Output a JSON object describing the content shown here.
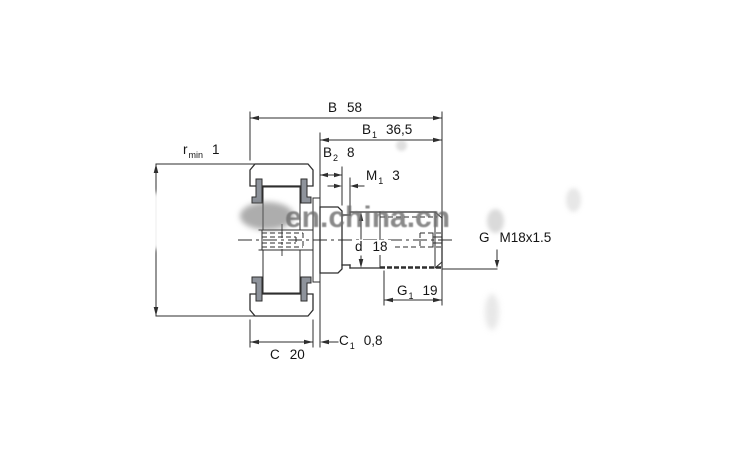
{
  "watermark": {
    "text": "en.china.cn"
  },
  "dimensions": {
    "r_min": {
      "symbol": "r",
      "subscript": "min",
      "value": "1"
    },
    "B": {
      "symbol": "B",
      "subscript": "",
      "value": "58"
    },
    "B1": {
      "symbol": "B",
      "subscript": "1",
      "value": "36,5"
    },
    "B2": {
      "symbol": "B",
      "subscript": "2",
      "value": "8"
    },
    "M1": {
      "symbol": "M",
      "subscript": "1",
      "value": "3"
    },
    "d": {
      "symbol": "d",
      "subscript": "",
      "value": "18"
    },
    "G1": {
      "symbol": "G",
      "subscript": "1",
      "value": "19"
    },
    "C": {
      "symbol": "C",
      "subscript": "",
      "value": "20"
    },
    "C1": {
      "symbol": "C",
      "subscript": "1",
      "value": "0,8"
    },
    "G": {
      "symbol": "G",
      "subscript": "",
      "value": "M18x1.5"
    }
  },
  "colors": {
    "ring_fill": "#cdd9e8",
    "hatch_line": "#a9b7cc",
    "line": "#2e2e2e",
    "washer_fill": "#8e939b",
    "watermark": "#6e6e6e"
  }
}
